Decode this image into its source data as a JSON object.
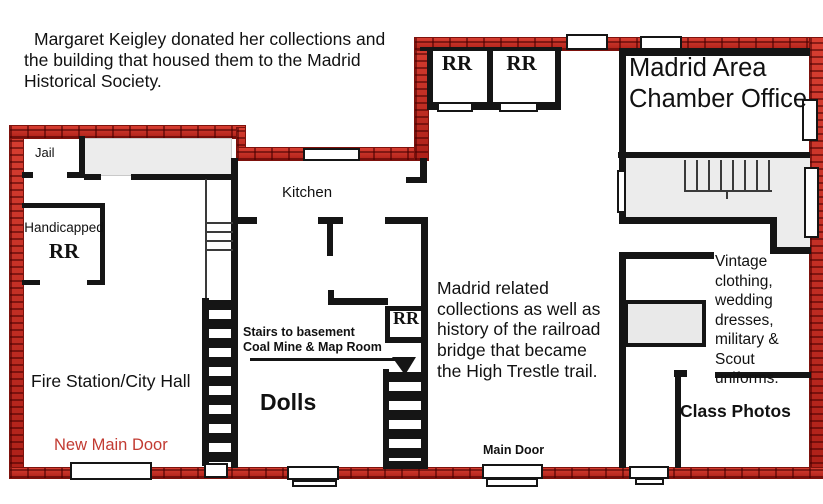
{
  "title_note": {
    "lines": [
      "Margaret Keigley donated her collections and",
      "the building that housed them to the Madrid",
      "Historical Society."
    ]
  },
  "rooms": {
    "jail": "Jail",
    "handicapped_line1": "Handicapped",
    "handicapped_line2": "RR",
    "fire_station": "Fire Station/City Hall",
    "kitchen": "Kitchen",
    "dolls": "Dolls",
    "restroom_top_1": "RR",
    "restroom_top_2": "RR",
    "restroom_mid": "RR",
    "chamber": {
      "lines": [
        "Madrid Area",
        "Chamber Office"
      ]
    },
    "class_photos": "Class Photos"
  },
  "annotations": {
    "basement_stairs": {
      "lines": [
        "Stairs to basement",
        "Coal Mine & Map Room"
      ]
    },
    "collections": {
      "lines": [
        "Madrid related",
        "collections as well as",
        "history of the railroad",
        "bridge that became",
        "the High Trestle trail."
      ]
    },
    "vintage": {
      "lines": [
        "Vintage",
        "clothing,",
        "wedding",
        "dresses,",
        "military &",
        "Scout",
        "uniforms."
      ]
    }
  },
  "doors": {
    "new_main": "New Main Door",
    "main": "Main Door"
  },
  "colors": {
    "brick_red": "#c5291f",
    "wall_black": "#151515",
    "door_label_red": "#c23b32",
    "fill_gray": "#ececec"
  }
}
